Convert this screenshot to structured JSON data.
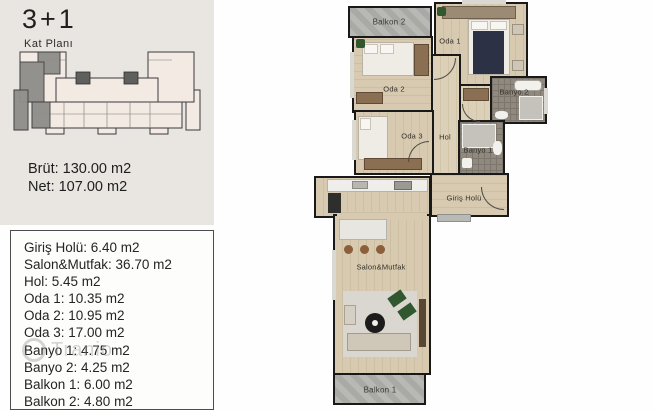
{
  "meta": {
    "title": "3+1",
    "subtitle": "Kat Planı"
  },
  "summary": {
    "brut": "Brüt: 130.00 m2",
    "net": "Net: 107.00 m2"
  },
  "room_list": [
    "Giriş Holü: 6.40 m2",
    "Salon&Mutfak: 36.70 m2",
    "Hol: 5.45 m2",
    "Oda 1: 10.35 m2",
    "Oda 2: 10.95 m2",
    "Oda 3: 17.00 m2",
    "Banyo 1: 4.75 m2",
    "Banyo 2: 4.25 m2",
    "Balkon 1: 6.00 m2",
    "Balkon 2: 4.80 m2"
  ],
  "plan_labels": {
    "balkon2": "Balkon 2",
    "oda1": "Oda 1",
    "oda2": "Oda 2",
    "banyo2": "Banyo 2",
    "oda3": "Oda 3",
    "hol": "Hol",
    "banyo1": "Banyo 1",
    "giris_holu": "Giriş Holü",
    "salon_mutfak": "Salon&Mutfak",
    "balkon1": "Balkon 1"
  },
  "watermark": "Tranio",
  "colors": {
    "panel_bg": "#e9e6e1",
    "wall": "#191919",
    "wood_floor": "#d5c7ac",
    "balcony_grey": "#b7b8b4",
    "highlighted_unit": "#8f8e8b",
    "keyplan_fill": "#f3eae3",
    "plant_green": "#30572e",
    "bed_navy": "#2c3146"
  }
}
